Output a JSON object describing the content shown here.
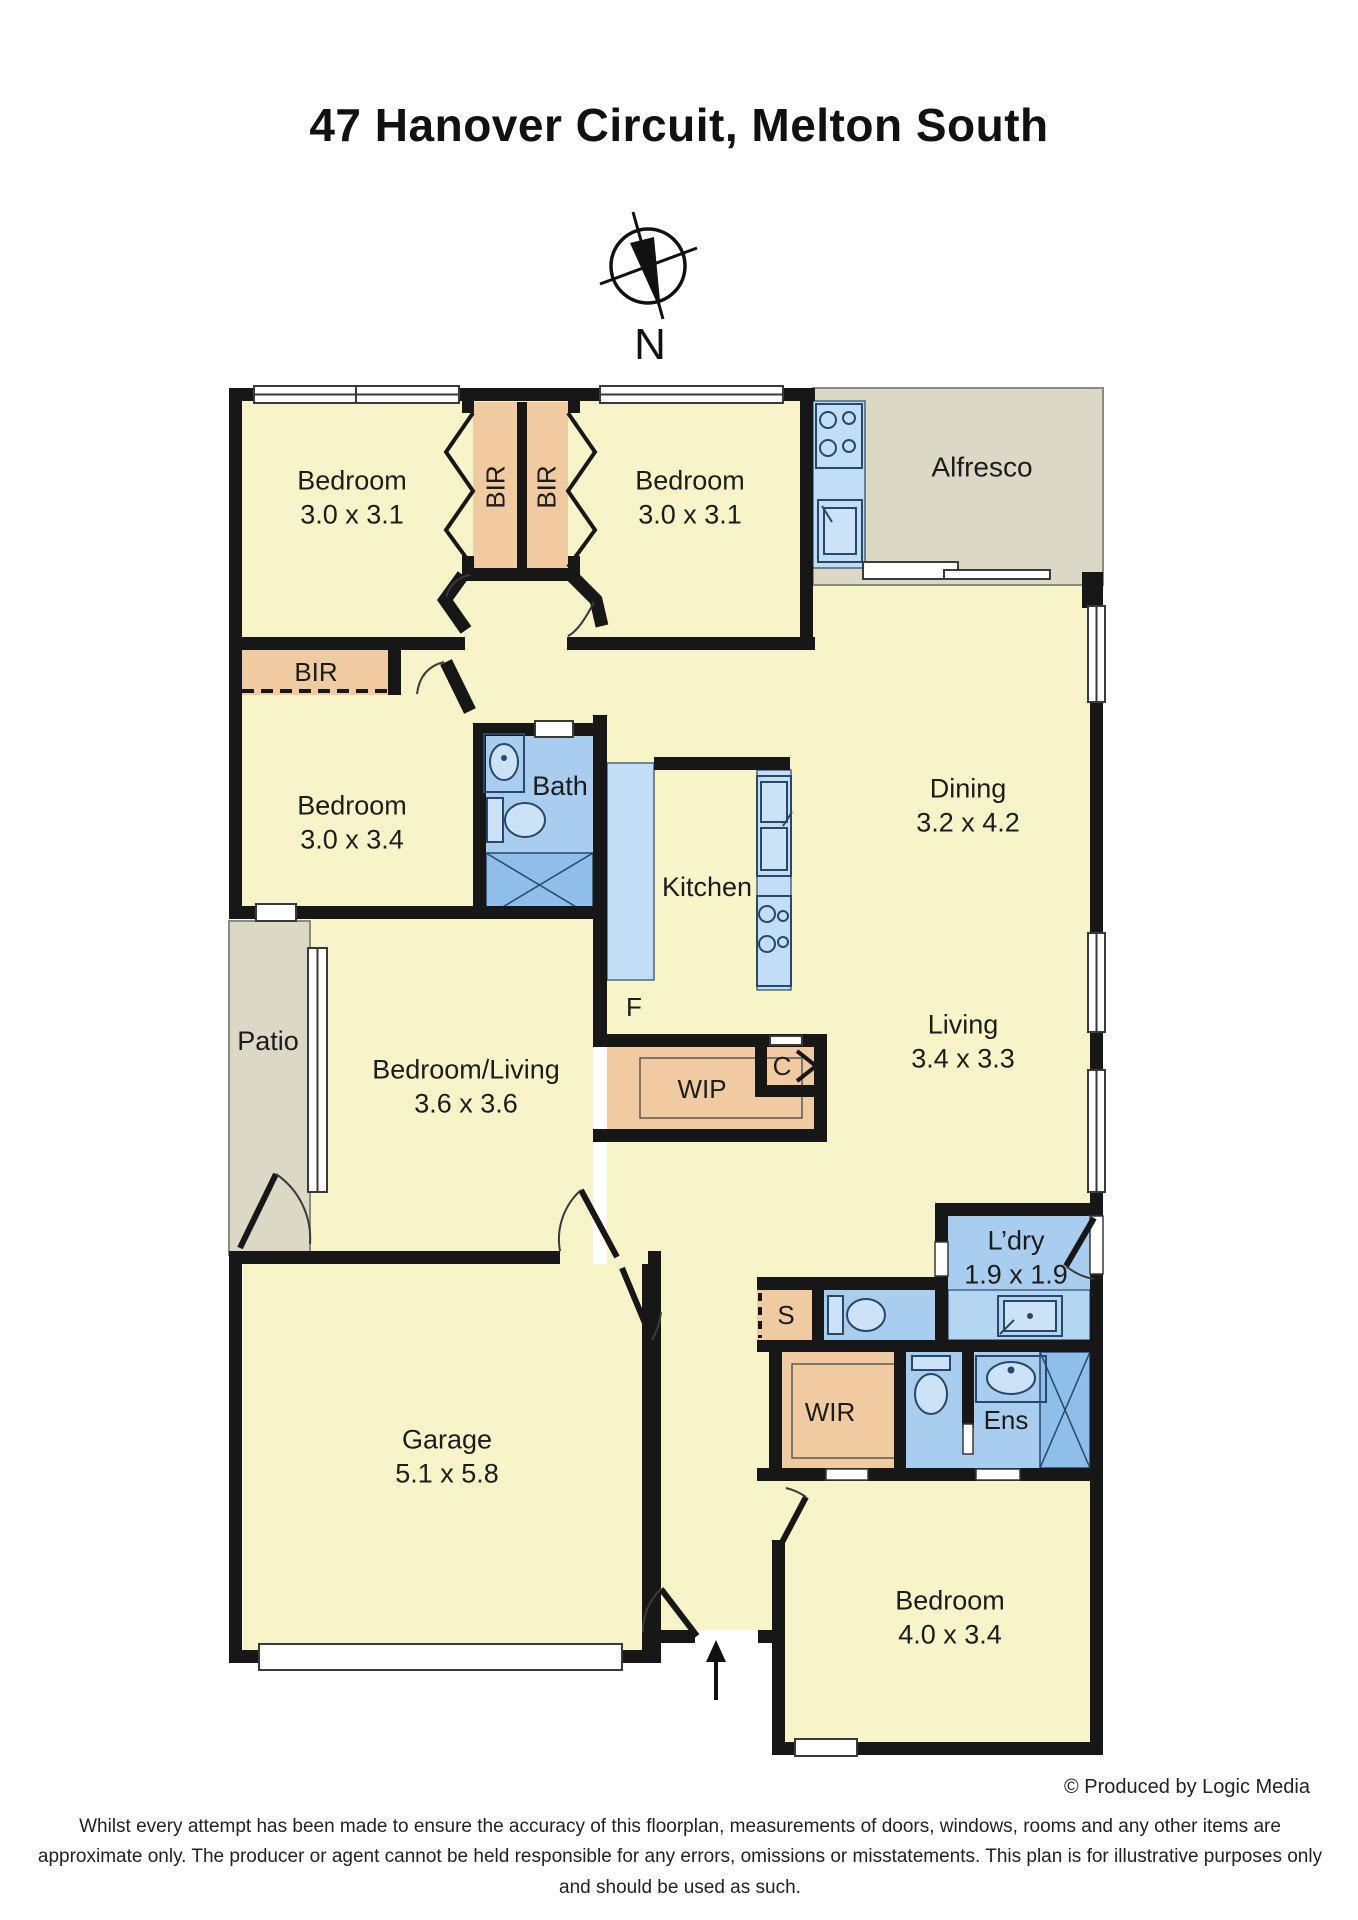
{
  "title": "47 Hanover Circuit, Melton South",
  "compass": {
    "north_label": "N"
  },
  "rooms": {
    "bedroom1": {
      "name": "Bedroom",
      "dims": "3.0 x 3.1"
    },
    "bedroom2": {
      "name": "Bedroom",
      "dims": "3.0 x 3.1"
    },
    "bedroom3": {
      "name": "Bedroom",
      "dims": "3.0 x 3.4"
    },
    "bedroom4": {
      "name": "Bedroom",
      "dims": "4.0 x 3.4"
    },
    "bedroom_living": {
      "name": "Bedroom/Living",
      "dims": "3.6 x 3.6"
    },
    "dining": {
      "name": "Dining",
      "dims": "3.2 x 4.2"
    },
    "living": {
      "name": "Living",
      "dims": "3.4 x 3.3"
    },
    "garage": {
      "name": "Garage",
      "dims": "5.1 x 5.8"
    },
    "laundry": {
      "name": "L’dry",
      "dims": "1.9 x 1.9"
    },
    "alfresco": {
      "name": "Alfresco"
    },
    "patio": {
      "name": "Patio"
    },
    "kitchen": {
      "name": "Kitchen"
    },
    "bath": {
      "name": "Bath"
    },
    "ens": {
      "name": "Ens"
    },
    "wir": {
      "name": "WIR"
    },
    "wip": {
      "name": "WIP"
    },
    "bir1": {
      "name": "BIR"
    },
    "bir2": {
      "name": "BIR"
    },
    "bir3": {
      "name": "BIR"
    },
    "cupboard": {
      "name": "C"
    },
    "store": {
      "name": "S"
    },
    "fridge": {
      "name": "F"
    }
  },
  "footer": {
    "credit": "© Produced by Logic Media",
    "disclaimer": "Whilst every attempt has been made to ensure the accuracy of this floorplan, measurements of doors, windows, rooms and any other items are approximate only. The producer or agent cannot be held responsible for any errors, omissions or misstatements. This plan is for illustrative purposes only and should be used as such."
  },
  "colors": {
    "floor_yellow": "#F8F4C9",
    "closet_peach": "#F0CBA1",
    "wet_blue": "#A8CDEF",
    "bench_blue": "#C2DDF6",
    "shower_blue": "#8EBEE9",
    "outdoor_grey": "#DBD8C6",
    "wall_black": "#171717"
  }
}
